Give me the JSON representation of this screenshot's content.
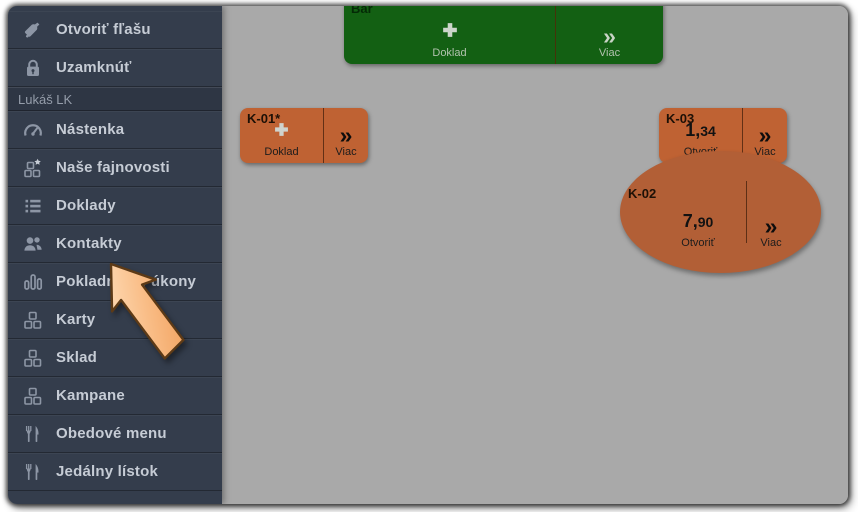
{
  "sidebar": {
    "user": {
      "label": "Lukáš LK"
    },
    "items": [
      {
        "label": "Otvoriť fľašu",
        "icon": "bottle-icon"
      },
      {
        "label": "Uzamknúť",
        "icon": "lock-icon"
      },
      {
        "label": "Nástenka",
        "icon": "dashboard-gauge-icon"
      },
      {
        "label": "Naše fajnovosti",
        "icon": "blocks-star-icon"
      },
      {
        "label": "Doklady",
        "icon": "list-icon"
      },
      {
        "label": "Kontakty",
        "icon": "users-icon"
      },
      {
        "label": "Pokladničné úkony",
        "icon": "bar-chart-icon"
      },
      {
        "label": "Karty",
        "icon": "blocks-icon"
      },
      {
        "label": "Sklad",
        "icon": "blocks-icon"
      },
      {
        "label": "Kampane",
        "icon": "blocks-icon"
      },
      {
        "label": "Obedové menu",
        "icon": "cutlery-icon"
      },
      {
        "label": "Jedálny lístok",
        "icon": "cutlery-icon"
      }
    ]
  },
  "tables": {
    "bar": {
      "name": "Bar",
      "action_primary": "Doklad",
      "action_more": "Viac"
    },
    "k01": {
      "name": "K-01*",
      "action_primary": "Doklad",
      "action_more": "Viac"
    },
    "k03": {
      "name": "K-03",
      "value_int": "1,",
      "value_frac": "34",
      "action_open": "Otvoriť",
      "action_more": "Viac"
    },
    "k02": {
      "name": "K-02",
      "value_int": "7,",
      "value_frac": "90",
      "action_open": "Otvoriť",
      "action_more": "Viac"
    }
  },
  "icons": {
    "more_chevrons": "»"
  },
  "pointer": {
    "description": "large orange arrow cursor",
    "target": "Kontakty"
  },
  "colors": {
    "sidebar_bg": "#343d4c",
    "canvas_bg": "#a9a9a9",
    "table_free_green": "#136013",
    "table_open_orange": "#bf6233",
    "table_open_ellipse": "#b25f36",
    "arrow_fill": "#f8b878",
    "menu_text": "#c6ccd5"
  }
}
